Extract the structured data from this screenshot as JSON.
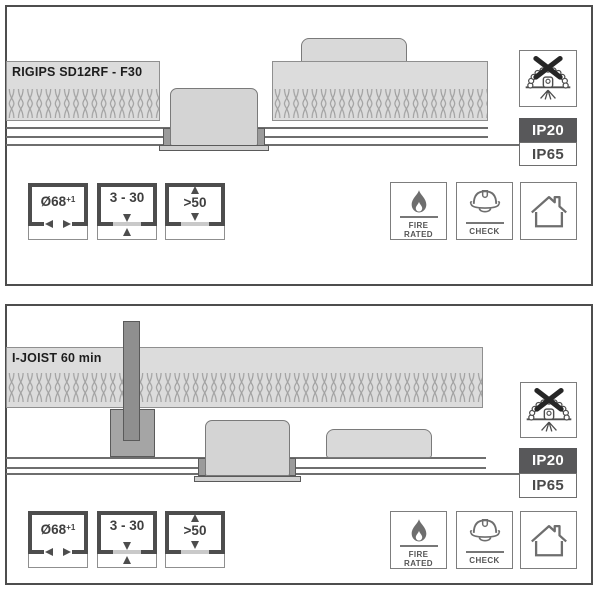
{
  "colors": {
    "panel_border": "#4d4d4d",
    "band_fill": "#dcdcdc",
    "ip_active_bg": "#58585a",
    "line_gray": "#6e6e6e"
  },
  "panel1": {
    "construction_label": "RIGIPS SD12RF - F30",
    "dims": [
      {
        "name": "cutout-diameter",
        "value": "Ø68",
        "sup": "+1"
      },
      {
        "name": "ceiling-thickness",
        "value": "3 - 30"
      },
      {
        "name": "clearance-above",
        "value": ">50"
      }
    ],
    "ip": {
      "active": "IP20",
      "inactive": "IP65"
    },
    "cert": {
      "fire_line1": "FIRE",
      "fire_line2": "RATED",
      "check": "CHECK"
    }
  },
  "panel2": {
    "construction_label": "I-JOIST 60 min",
    "dims": [
      {
        "name": "cutout-diameter",
        "value": "Ø68",
        "sup": "+1"
      },
      {
        "name": "ceiling-thickness",
        "value": "3 - 30"
      },
      {
        "name": "clearance-above",
        "value": ">50"
      }
    ],
    "ip": {
      "active": "IP20",
      "inactive": "IP65"
    },
    "cert": {
      "fire_line1": "FIRE",
      "fire_line2": "RATED",
      "check": "CHECK"
    }
  }
}
